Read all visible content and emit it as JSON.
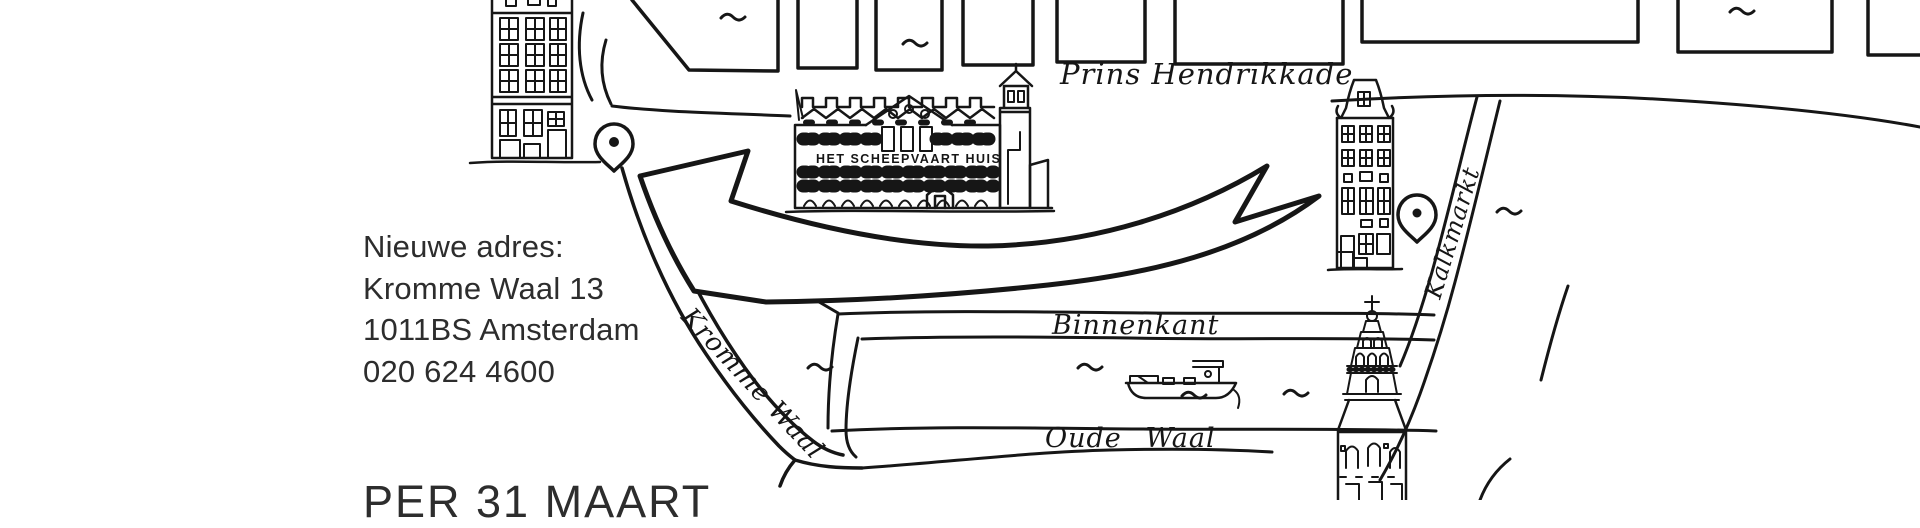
{
  "announcement": {
    "heading": "Nieuwe adres:",
    "address_line": "Kromme Waal 13",
    "postal_city": "1011BS Amsterdam",
    "phone": "020 624 4600",
    "moving_date": "PER 31 MAART"
  },
  "map": {
    "street_labels": {
      "prins_hendrikkade": "Prins Hendrikkade",
      "binnenkant": "Binnenkant",
      "oude_waal": "Oude Waal",
      "kromme_waal": "Kromme Waal",
      "kalkmarkt": "Kalkmarkt"
    },
    "building_labels": {
      "scheepvaart_huis": "HET SCHEEPVAART HUIS"
    },
    "markers": {
      "left_pin": "location-pin",
      "right_pin": "location-pin"
    },
    "colors": {
      "ink": "#161616",
      "text": "#2d2d2d",
      "background": "#ffffff"
    }
  }
}
